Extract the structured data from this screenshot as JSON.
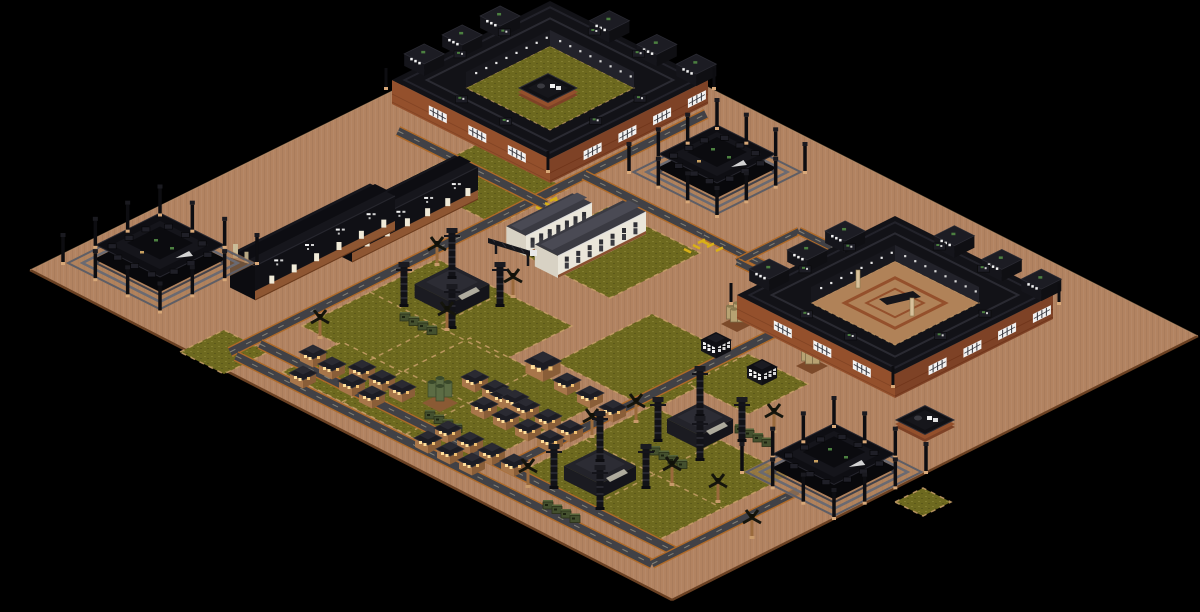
{
  "meta": {
    "title": "Isometric strategy game map - desert industrial colony",
    "view": "isometric",
    "background_color": "#000000"
  },
  "colors": {
    "terrain": "#b28361",
    "terrain_edge": "#6a4022",
    "terrain_hi": "#c9a076",
    "grass": "#6d691f",
    "grass_hi": "#85802e",
    "road": "#414146",
    "road_edge": "#b06a28",
    "road_dash": "#d8cfae",
    "brick": "#94502c",
    "brick_dark": "#7e4226",
    "brick_hi": "#b06a42",
    "roof_black": "#121217",
    "roof_dark": "#1c1c23",
    "roof_gray": "#3a3a42",
    "deck": "#5e5e66",
    "white": "#f2f2f2",
    "window_lit": "#ffdf9a",
    "palm_trunk": "#9a6a3c",
    "palm_top": "#15150d",
    "machine": "#44502e",
    "silo_green": "#5c6c44",
    "silo_tan": "#b7a272",
    "hazard": "#d8b018",
    "path_dash": "#c9a06a",
    "sand": "#b08258",
    "hut_wall": "#a8764a",
    "hut_wall_dark": "#8a5e38",
    "office_wall": "#eae6da",
    "vent_green": "#4c8040",
    "pillar": "#d8c09a"
  },
  "terrain": {
    "points": [
      [
        556,
        10
      ],
      [
        1198,
        336
      ],
      [
        672,
        600
      ],
      [
        30,
        270
      ]
    ]
  },
  "grass": [
    {
      "pts": [
        [
          302,
          326
        ],
        [
          437,
          259
        ],
        [
          572,
          326
        ],
        [
          437,
          393
        ]
      ]
    },
    {
      "pts": [
        [
          518,
          252
        ],
        [
          608,
          207
        ],
        [
          700,
          253
        ],
        [
          610,
          298
        ]
      ]
    },
    {
      "pts": [
        [
          282,
          372
        ],
        [
          342,
          342
        ],
        [
          414,
          378
        ],
        [
          354,
          408
        ]
      ]
    },
    {
      "pts": [
        [
          342,
          402
        ],
        [
          470,
          338
        ],
        [
          600,
          403
        ],
        [
          472,
          467
        ]
      ]
    },
    {
      "pts": [
        [
          556,
          362
        ],
        [
          652,
          314
        ],
        [
          748,
          362
        ],
        [
          652,
          410
        ]
      ]
    },
    {
      "pts": [
        [
          520,
          472
        ],
        [
          652,
          406
        ],
        [
          790,
          475
        ],
        [
          656,
          541
        ]
      ]
    },
    {
      "pts": [
        [
          406,
          180
        ],
        [
          478,
          144
        ],
        [
          568,
          189
        ],
        [
          496,
          225
        ]
      ]
    },
    {
      "pts": [
        [
          688,
          384
        ],
        [
          748,
          354
        ],
        [
          808,
          384
        ],
        [
          748,
          414
        ]
      ]
    },
    {
      "pts": [
        [
          180,
          352
        ],
        [
          224,
          330
        ],
        [
          268,
          352
        ],
        [
          224,
          374
        ]
      ]
    },
    {
      "pts": [
        [
          895,
          502
        ],
        [
          923,
          488
        ],
        [
          951,
          502
        ],
        [
          923,
          516
        ]
      ]
    }
  ],
  "grid_lines": [
    [
      [
        370,
        292
      ],
      [
        504,
        360
      ]
    ],
    [
      [
        370,
        360
      ],
      [
        504,
        292
      ]
    ],
    [
      [
        404,
        371
      ],
      [
        536,
        437
      ]
    ],
    [
      [
        406,
        434
      ],
      [
        536,
        370
      ]
    ],
    [
      [
        586,
        440
      ],
      [
        722,
        508
      ]
    ],
    [
      [
        588,
        508
      ],
      [
        722,
        440
      ]
    ]
  ],
  "roads": [
    {
      "a": [
        230,
        352
      ],
      "b": [
        706,
        114
      ],
      "w": 10
    },
    {
      "a": [
        398,
        131
      ],
      "b": [
        546,
        205
      ],
      "w": 10
    },
    {
      "a": [
        584,
        175
      ],
      "b": [
        704,
        235
      ],
      "w": 10
    },
    {
      "a": [
        704,
        235
      ],
      "b": [
        788,
        277
      ],
      "w": 9
    },
    {
      "a": [
        737,
        262
      ],
      "b": [
        799,
        231
      ],
      "w": 8
    },
    {
      "a": [
        799,
        231
      ],
      "b": [
        884,
        273
      ],
      "w": 8
    },
    {
      "a": [
        884,
        273
      ],
      "b": [
        822,
        304
      ],
      "w": 8
    },
    {
      "a": [
        822,
        304
      ],
      "b": [
        737,
        262
      ],
      "w": 8
    },
    {
      "a": [
        548,
        446
      ],
      "b": [
        788,
        326
      ],
      "w": 10
    },
    {
      "a": [
        236,
        356
      ],
      "b": [
        652,
        564
      ],
      "w": 10
    },
    {
      "a": [
        260,
        344
      ],
      "b": [
        676,
        552
      ],
      "w": 10
    },
    {
      "a": [
        652,
        564
      ],
      "b": [
        798,
        491
      ],
      "w": 9
    },
    {
      "a": [
        548,
        446
      ],
      "b": [
        504,
        468
      ],
      "w": 9
    }
  ],
  "hazard_marks": [
    [
      552,
      205
    ],
    [
      700,
      247
    ]
  ],
  "complexes": [
    {
      "name": "factory-complex-north",
      "cx": 550,
      "cy": 80,
      "rx": 158,
      "court_rx": 84,
      "court": "grass",
      "pad": true,
      "pillars": []
    },
    {
      "name": "factory-complex-east",
      "cx": 895,
      "cy": 295,
      "rx": 158,
      "court_rx": 84,
      "court": "sand",
      "pad": false,
      "pillars": [
        [
          858,
          288
        ],
        [
          912,
          316
        ]
      ]
    }
  ],
  "pavilions": [
    {
      "name": "depot-pavilion-west",
      "cx": 160,
      "cy": 263,
      "rx": 97
    },
    {
      "name": "depot-pavilion-mid",
      "cx": 717,
      "cy": 172,
      "rx": 88
    },
    {
      "name": "depot-pavilion-south",
      "cx": 834,
      "cy": 472,
      "rx": 92
    }
  ],
  "long_buildings": [
    {
      "name": "workshop-row-a",
      "p1": [
        255,
        300
      ],
      "p2": [
        395,
        230
      ],
      "d": 28,
      "h": 34
    },
    {
      "name": "workshop-row-b",
      "p1": [
        352,
        262
      ],
      "p2": [
        478,
        199
      ],
      "d": 26,
      "h": 32
    }
  ],
  "office": {
    "name": "hq-office-building",
    "blocks": [
      {
        "p1": [
          526,
          256
        ],
        "p2": [
          592,
          223
        ],
        "d": 22,
        "h": 20
      },
      {
        "p1": [
          558,
          278
        ],
        "p2": [
          646,
          234
        ],
        "d": 26,
        "h": 22
      }
    ],
    "crane": {
      "a": [
        488,
        238
      ],
      "b": [
        534,
        252
      ]
    }
  },
  "drill_sites": [
    {
      "cx": 452,
      "cy": 298,
      "rx": 52
    },
    {
      "cx": 600,
      "cy": 480,
      "rx": 50
    },
    {
      "cx": 700,
      "cy": 433,
      "rx": 46
    }
  ],
  "huts": [
    [
      313,
      352
    ],
    [
      332,
      364
    ],
    [
      303,
      373
    ],
    [
      362,
      367
    ],
    [
      382,
      377
    ],
    [
      402,
      387
    ],
    [
      352,
      381
    ],
    [
      372,
      393
    ],
    [
      475,
      377
    ],
    [
      495,
      387
    ],
    [
      515,
      397
    ],
    [
      567,
      380
    ],
    [
      590,
      393
    ],
    [
      613,
      407
    ],
    [
      484,
      404
    ],
    [
      506,
      415
    ],
    [
      528,
      426
    ],
    [
      550,
      437
    ],
    [
      504,
      394
    ],
    [
      526,
      405
    ],
    [
      548,
      416
    ],
    [
      570,
      427
    ],
    [
      428,
      438
    ],
    [
      450,
      449
    ],
    [
      472,
      460
    ],
    [
      448,
      428
    ],
    [
      470,
      439
    ],
    [
      492,
      450
    ],
    [
      514,
      461
    ]
  ],
  "hut_large": [
    [
      543,
      361
    ]
  ],
  "palms": [
    [
      320,
      338
    ],
    [
      437,
      265
    ],
    [
      513,
      297
    ],
    [
      447,
      330
    ],
    [
      592,
      437
    ],
    [
      636,
      422
    ],
    [
      672,
      485
    ],
    [
      528,
      487
    ],
    [
      718,
      502
    ],
    [
      774,
      432
    ],
    [
      752,
      538
    ]
  ],
  "machine_rows": [
    [
      405,
      318
    ],
    [
      430,
      416
    ],
    [
      548,
      506
    ],
    [
      655,
      452
    ],
    [
      740,
      430
    ]
  ],
  "silos_green": [
    [
      440,
      398
    ]
  ],
  "silos_tan": [
    [
      737,
      320
    ],
    [
      812,
      362
    ]
  ],
  "checker_depots": [
    [
      716,
      340
    ],
    [
      762,
      367
    ]
  ],
  "pads": [
    [
      925,
      420
    ]
  ]
}
